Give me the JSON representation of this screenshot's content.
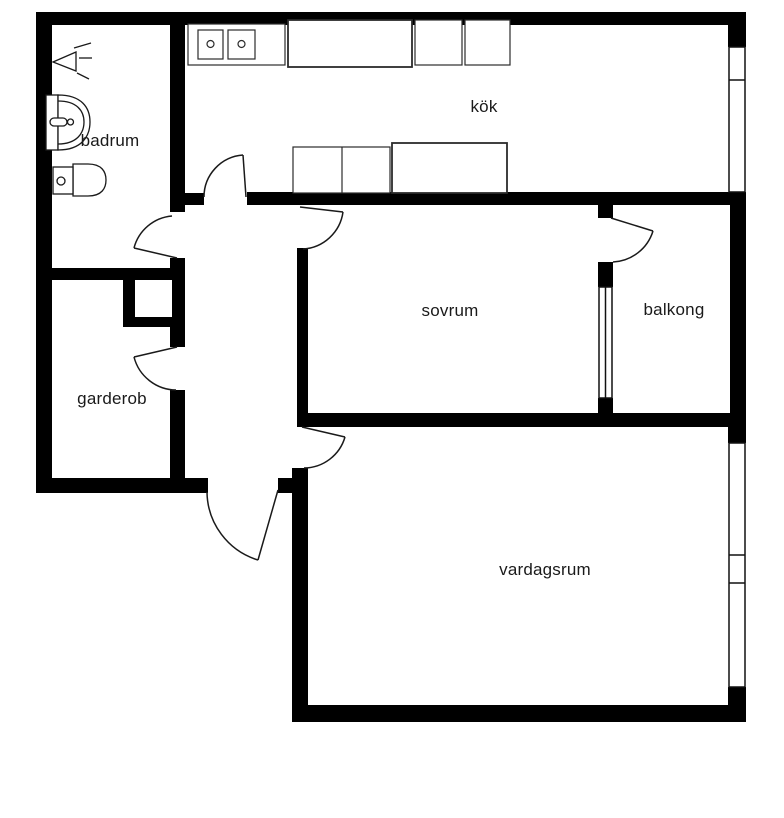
{
  "page": {
    "background": "#ffffff"
  },
  "plan": {
    "wall_color": "#000000",
    "line_color": "#1a1a1a",
    "rooms": [
      {
        "id": "badrum",
        "label": "badrum"
      },
      {
        "id": "kok",
        "label": "kök"
      },
      {
        "id": "sovrum",
        "label": "sovrum"
      },
      {
        "id": "balkong",
        "label": "balkong"
      },
      {
        "id": "garderob",
        "label": "garderob"
      },
      {
        "id": "vardagsrum",
        "label": "vardagsrum"
      }
    ],
    "fixtures": [
      {
        "id": "shower",
        "name": "shower-symbol"
      },
      {
        "id": "washbasin",
        "name": "washbasin-symbol"
      },
      {
        "id": "toilet",
        "name": "toilet-symbol"
      },
      {
        "id": "kitchen-sink",
        "name": "double-basin-sink-symbol"
      },
      {
        "id": "counters",
        "name": "kitchen-counter-symbols"
      },
      {
        "id": "closet",
        "name": "built-in-closet-symbol"
      }
    ]
  }
}
